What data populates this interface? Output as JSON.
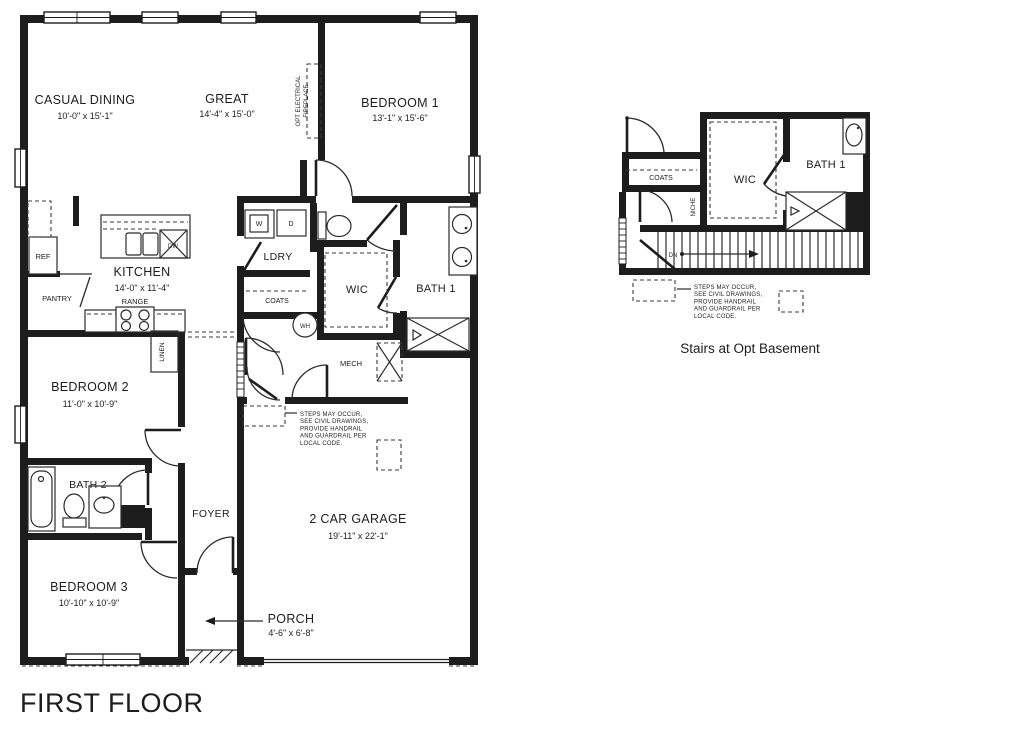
{
  "title": "FIRST FLOOR",
  "detail_caption": "Stairs at Opt Basement",
  "rooms": {
    "casual_dining": {
      "name": "CASUAL DINING",
      "dims": "10'-0\" x 15'-1\""
    },
    "great": {
      "name": "GREAT",
      "dims": "14'-4\" x 15'-0\""
    },
    "bedroom1": {
      "name": "BEDROOM 1",
      "dims": "13'-1\" x 15'-6\""
    },
    "kitchen": {
      "name": "KITCHEN",
      "dims": "14'-0\" x 11'-4\""
    },
    "bedroom2": {
      "name": "BEDROOM 2",
      "dims": "11'-0\" x 10'-9\""
    },
    "bedroom3": {
      "name": "BEDROOM 3",
      "dims": "10'-10\" x 10'-9\""
    },
    "garage": {
      "name": "2 CAR GARAGE",
      "dims": "19'-11\" x 22'-1\""
    },
    "porch": {
      "name": "PORCH",
      "dims": "4'-6\" x 6'-8\""
    },
    "ldry": {
      "name": "LDRY"
    },
    "wic": {
      "name": "WIC"
    },
    "bath1": {
      "name": "BATH 1"
    },
    "bath2": {
      "name": "BATH 2"
    },
    "foyer": {
      "name": "FOYER"
    },
    "mech": {
      "name": "MECH"
    }
  },
  "labels": {
    "pantry": "PANTRY",
    "coats": "COATS",
    "linen": "LINEN",
    "niche": "NICHE",
    "ref": "REF",
    "range": "RANGE",
    "dw": "DW",
    "washer": "W",
    "dryer": "D",
    "water_heater": "WH",
    "down": "DN",
    "fireplace_line1": "OPT ELECTRICAL",
    "fireplace_line2": "FIREPLACE"
  },
  "notes": {
    "steps": [
      "STEPS MAY OCCUR,",
      "SEE CIVIL DRAWINGS,",
      "PROVIDE HANDRAIL",
      "AND GUARDRAIL PER",
      "LOCAL CODE."
    ]
  },
  "colors": {
    "ink": "#1d1d1d",
    "background": "#ffffff"
  }
}
